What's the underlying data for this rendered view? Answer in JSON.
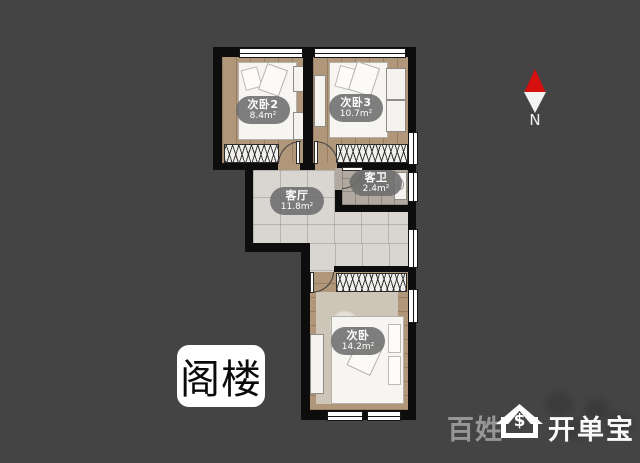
{
  "floor_badge": "阁楼",
  "rooms": [
    {
      "id": "bedroom2",
      "name": "次卧2",
      "area": "8.4m²"
    },
    {
      "id": "bedroom3",
      "name": "次卧3",
      "area": "10.7m²"
    },
    {
      "id": "living",
      "name": "客厅",
      "area": "11.8m²"
    },
    {
      "id": "bathroom",
      "name": "客卫",
      "area": "2.4m²"
    },
    {
      "id": "bedroom1",
      "name": "次卧",
      "area": "14.2m²"
    }
  ],
  "compass": {
    "label": "N"
  },
  "watermark": {
    "left_text": "百姓",
    "right_text": "开单宝",
    "icon_symbol": "$"
  },
  "colors": {
    "background": "#444444",
    "wall": "#0d0d0d",
    "wood_floor": "#b1977a",
    "tile_floor": "#d9d6d1",
    "bath_floor": "#b2aaa0",
    "compass_red": "#d60f0f",
    "watermark_gray": "#969696"
  }
}
